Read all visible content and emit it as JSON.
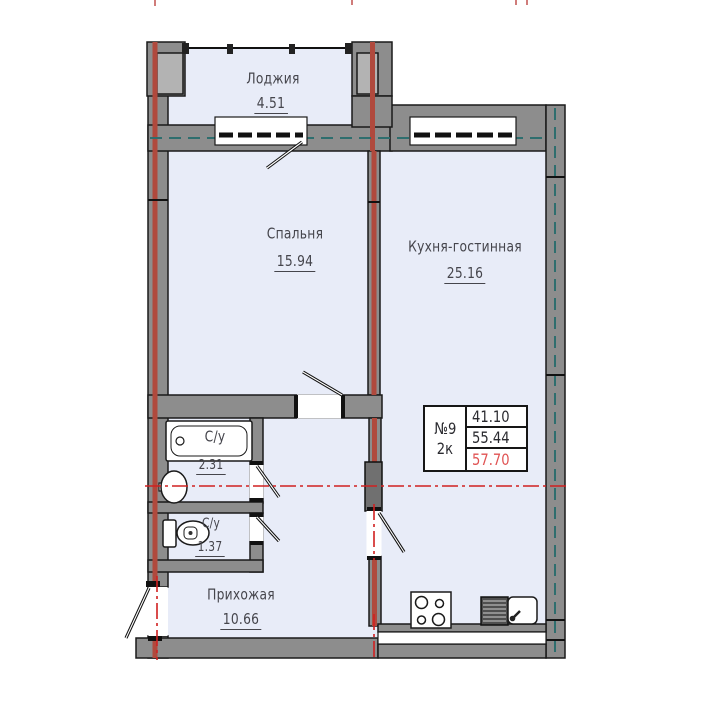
{
  "rooms": {
    "loggia": {
      "name": "Лоджия",
      "area": "4.51"
    },
    "bedroom": {
      "name": "Спальня",
      "area": "15.94"
    },
    "kitchen_living": {
      "name": "Кухня-гостинная",
      "area": "25.16"
    },
    "bathroom": {
      "name": "С/у",
      "area": "2.31"
    },
    "wc": {
      "name": "С/у",
      "area": "1.37"
    },
    "hallway": {
      "name": "Прихожая",
      "area": "10.66"
    }
  },
  "info_box": {
    "apartment_number": "№9",
    "rooms_count": "2к",
    "areas": [
      "41.10",
      "55.44",
      "57.70"
    ]
  },
  "colors": {
    "room_fill": "#e8ecf8",
    "wall_gray": "#8d8d8d",
    "pillar_inner_gray": "#b3b3b3",
    "pilaster_gray": "#707070",
    "brick_axis_red": "#b0493d",
    "axis_line_red": "#d02020",
    "axis_line_teal": "#2e6e6e",
    "outline_black": "#1a1a1a",
    "label_color": "#45454c",
    "highlight_area_red": "#e05353"
  }
}
